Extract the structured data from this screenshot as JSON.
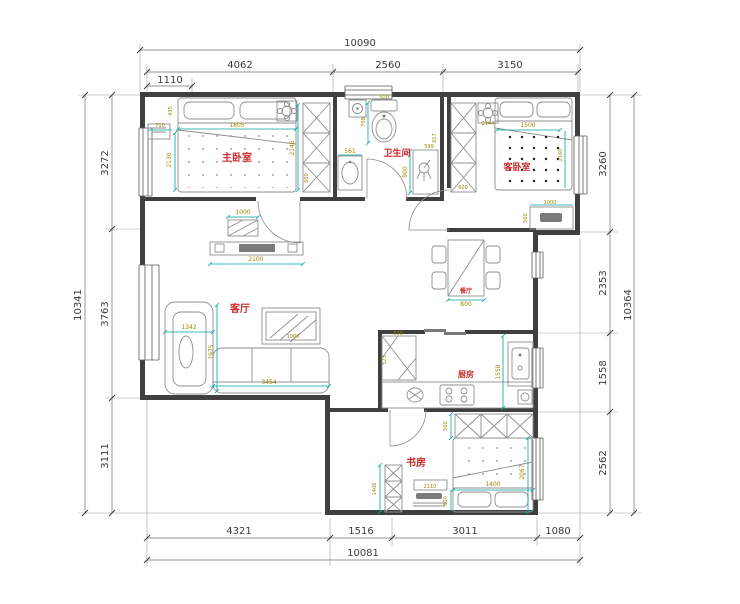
{
  "colors": {
    "bg": "#ffffff",
    "wall": "#3f3f3f",
    "furn": "#8f8f8f",
    "windowline": "#5a5a5a",
    "odimline": "#6e6e6e",
    "odimtext": "#3a3a3a",
    "idimline": "#00a3a3",
    "idimtext": "#9a8a00",
    "roomlabel": "#cc2a2a"
  },
  "room_labels": {
    "master_bedroom": "主卧室",
    "bathroom": "卫生间",
    "guest_bedroom": "客卧室",
    "living_room": "客厅",
    "dining_room": "餐厅",
    "kitchen": "厨房",
    "study": "书房"
  },
  "outer_dims": {
    "top_total": "10090",
    "top_segments": [
      "4062",
      "2560",
      "3150"
    ],
    "top_sub": "1110",
    "bottom_segments": [
      "4321",
      "1516",
      "3011",
      "1080"
    ],
    "bottom_total": "10081",
    "left_total": "10341",
    "left_segments": [
      "3272",
      "3763",
      "3111"
    ],
    "right_segments": [
      "3260",
      "2353",
      "1558",
      "2562"
    ],
    "right_total": "10364"
  },
  "inner_dims": {
    "master": {
      "corner": "435",
      "nightstand": "710",
      "bed_width": "1805",
      "bed_left": "2130",
      "bed_right": "2146",
      "wardrobe": "600",
      "console": "1000"
    },
    "bathroom": {
      "toilet_width": "500",
      "toilet_depth": "708",
      "vanity": "561",
      "shower_a": "617",
      "shower_b": "599",
      "shower_depth": "900"
    },
    "guest": {
      "bed_width": "1500",
      "bed_length": "2160",
      "side_table": "2144",
      "wardrobe": "600",
      "dresser": "1000",
      "dresser_depth": "500"
    },
    "living": {
      "tv_console": "2100",
      "chaise": "1342",
      "sofa_depth": "1975",
      "sofa_width": "3454",
      "coffee_table": "1000"
    },
    "dining": {
      "table_width": "800"
    },
    "kitchen": {
      "counter_top": "600",
      "counter_left": "523",
      "height": "1558"
    },
    "study": {
      "wardrobe_depth": "500",
      "bookcase": "1406",
      "desk": "2110",
      "bed_width": "1400",
      "bed_length": "2067",
      "bed_side": "600"
    }
  }
}
